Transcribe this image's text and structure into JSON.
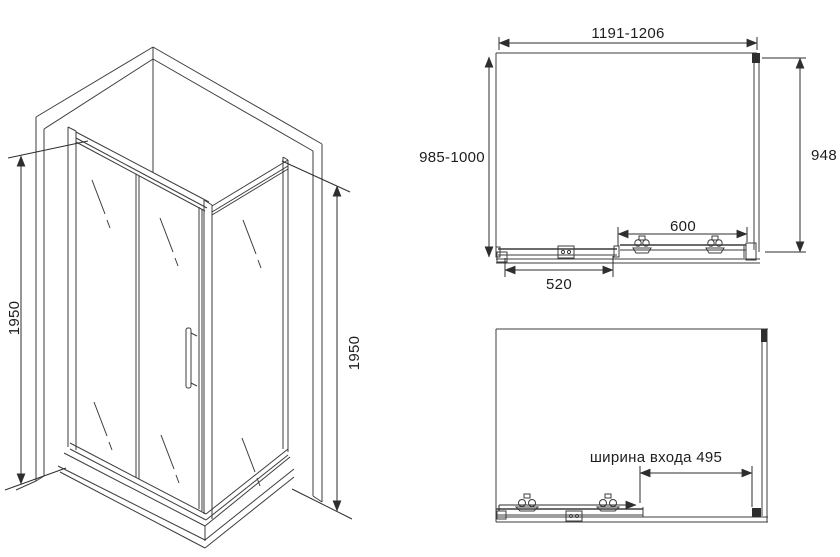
{
  "title": "Shower enclosure technical drawing",
  "colors": {
    "line": "#3c3c3c",
    "background": "#ffffff",
    "text": "#1d1d1d"
  },
  "iso_view": {
    "height_left": "1950",
    "height_right": "1950"
  },
  "top_view": {
    "width_range": "1191-1206",
    "depth_range": "985-1000",
    "side_panel": "948",
    "door_width": "600",
    "fixed_panel_width": "520"
  },
  "open_view": {
    "entrance_width": "ширина входа 495"
  }
}
